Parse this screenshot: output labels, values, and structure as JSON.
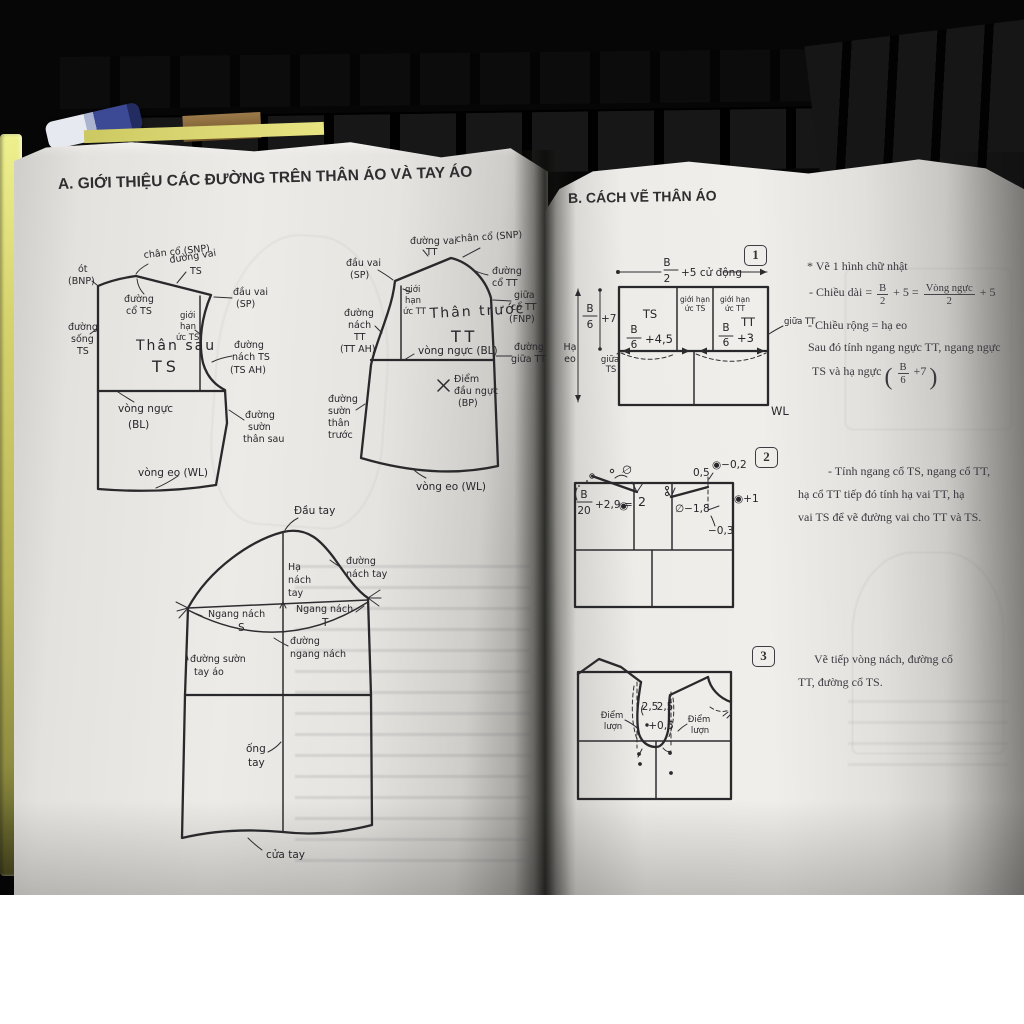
{
  "left_page": {
    "title": "A. GIỚI THIỆU CÁC ĐƯỜNG TRÊN THÂN ÁO VÀ TAY ÁO",
    "back": {
      "snp": "chân cổ (SNP)",
      "ot": "ót",
      "bnp": "(BNP)",
      "vai1": "đường vai",
      "vai2": "TS",
      "co1": "đường",
      "co2": "cổ TS",
      "sp1": "đầu vai",
      "sp2": "(SP)",
      "gh1": "giới",
      "gh2": "hạn",
      "gh3": "ức TS",
      "name": "Thân sau",
      "abbr": "TS",
      "song1": "đường",
      "song2": "sống",
      "song3": "TS",
      "nach1": "đường",
      "nach2": "nách TS",
      "nach3": "(TS AH)",
      "bust1": "vòng ngực",
      "bust2": "(BL)",
      "suon1": "đường",
      "suon2": "sườn",
      "suon3": "thân sau",
      "eo": "vòng eo (WL)"
    },
    "front": {
      "sp1": "đầu vai",
      "sp2": "(SP)",
      "vai1": "đường vai",
      "vai2": "TT",
      "snp": "chân cổ (SNP)",
      "co1": "đường",
      "co2": "cổ TT",
      "fnp1": "giữa",
      "fnp2": "cổ TT",
      "fnp3": "(FNP)",
      "gh1": "giới",
      "gh2": "hạn",
      "gh3": "ức TT",
      "name": "Thân trước",
      "abbr": "TT",
      "nach1": "đường",
      "nach2": "nách",
      "nach3": "TT",
      "nach4": "(TT AH)",
      "bust": "vòng ngực (BL)",
      "giua1": "đường",
      "giua2": "giữa TT",
      "bp1": "Điểm",
      "bp2": "đầu ngực",
      "bp3": "(BP)",
      "suon1": "đường",
      "suon2": "sườn",
      "suon3": "thân",
      "suon4": "trước",
      "eo": "vòng eo (WL)"
    },
    "sleeve": {
      "dau": "Đầu tay",
      "ha1": "Hạ",
      "ha2": "nách",
      "ha3": "tay",
      "dn1": "đường",
      "dn2": "nách tay",
      "ns1": "Ngang nách",
      "ns2": "S",
      "nt1": "Ngang nách",
      "nt2": "T",
      "ngang1": "đường",
      "ngang2": "ngang nách",
      "suon1": "đường sườn",
      "suon2": "tay áo",
      "ong1": "ống",
      "ong2": "tay",
      "cua": "cửa tay"
    }
  },
  "right_page": {
    "title": "B. CÁCH VẼ THÂN ÁO",
    "step1": {
      "badge": "1",
      "topn": "B",
      "topd": "2",
      "topr": "+5 cử động",
      "leftn": "B",
      "leftd": "6",
      "leftr": "+7",
      "haeo1": "Hạ",
      "haeo2": "eo",
      "ts": "TS",
      "tt": "TT",
      "ghts1": "giới hạn",
      "ghts2": "ức TS",
      "ghtt1": "giới hạn",
      "ghtt2": "ức TT",
      "bn1": "B",
      "bd1": "6",
      "br1": "+4,5",
      "bn2": "B",
      "bd2": "6",
      "br2": "+3",
      "giuats1": "giữa",
      "giuats2": "TS",
      "giuatt": "giữa TT",
      "wl": "WL",
      "n1": "* Vẽ 1 hình chữ nhật",
      "n2a": "- Chiều dài =",
      "n2f1n": "B",
      "n2f1d": "2",
      "n2b": "+ 5 =",
      "n2f2n": "Vòng ngực",
      "n2f2d": "2",
      "n2c": "+ 5",
      "n3": "- Chiều rộng = hạ eo",
      "n4": "Sau đó tính ngang ngực TT, ngang ngực",
      "n5a": "TS và hạ ngực",
      "n5po": "(",
      "n5fn": "B",
      "n5fd": "6",
      "n5b": "+7",
      "n5pc": ")"
    },
    "step2": {
      "badge": "2",
      "fn": "B",
      "fd": "20",
      "fr": "+2,9 =",
      "sym": "◉",
      "phi": "∅",
      "two": "2",
      "slope": "∅−1,8",
      "half": "0,5",
      "m02": "◉−0,2",
      "p1": "◉+1",
      "m03": "−0,3",
      "n1": "- Tính ngang cổ TS, ngang cổ TT,",
      "n2": "hạ cổ TT tiếp đó tính hạ vai TT, hạ",
      "n3": "vai TS để vẽ đường vai cho TT và TS."
    },
    "step3": {
      "badge": "3",
      "a": "2,5",
      "b": "2,5",
      "c": "+0,5",
      "dl1": "Điểm",
      "dl2": "lượn",
      "dr1": "Điểm",
      "dr2": "lượn",
      "n1": "Vẽ tiếp vòng nách, đường cổ",
      "n2": "TT, đường cổ TS."
    }
  }
}
